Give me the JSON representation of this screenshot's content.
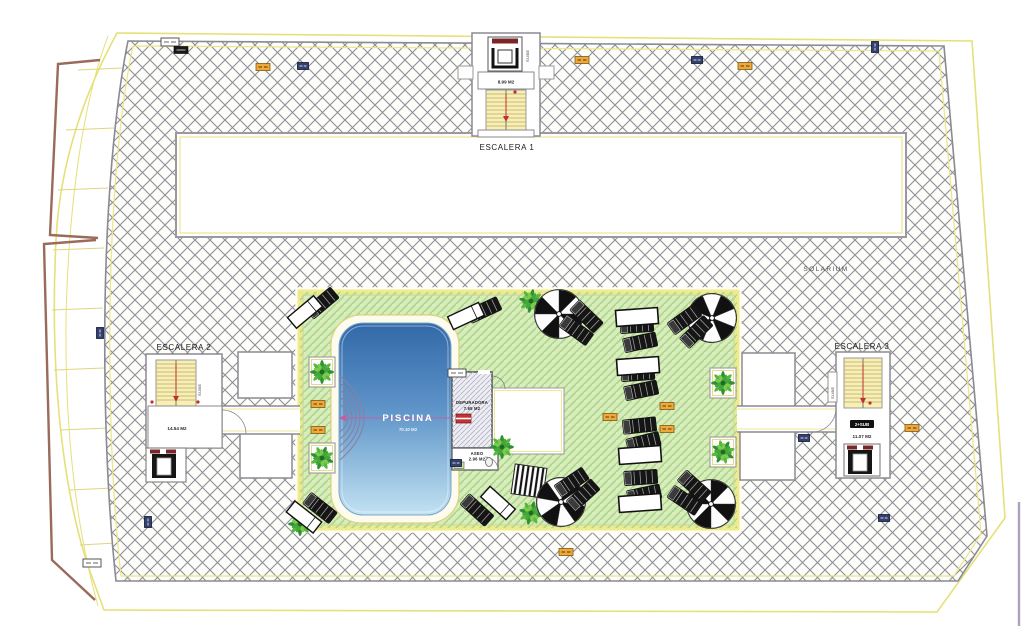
{
  "labels": {
    "escalera1": "ESCALERA 1",
    "escalera1_area": "8.99 M2",
    "escalera1_dir": "SUBE",
    "escalera2": "ESCALERA 2",
    "escalera2_area": "14.54 M2",
    "escalera2_dir": "SUBE",
    "escalera3": "ESCALERA 3",
    "escalera3_area": "11.07 M2",
    "escalera3_badge": "2+SUB",
    "escalera3_dir": "SUBE",
    "solarium": "SOLARIUM",
    "piscina": "PISCINA",
    "piscina_area": "70.10 M2",
    "depuradora": "DEPURADORA",
    "depuradora_area": "7.65 M2",
    "aseo": "ASEO",
    "aseo_area": "2.96 M2"
  },
  "colors": {
    "boundary_yellow": "#e6e07a",
    "hatch_gray": "#8a8a92",
    "lawn_green": "#d9ecbb",
    "lawn_hatch": "#aed890",
    "pool_top": "#3268a8",
    "pool_bottom": "#c2e2f2",
    "stair_yellow": "#f7efb4",
    "tag_orange": "#f0a83c",
    "tag_navy": "#34406e",
    "railing_brown": "#9a6a5a"
  },
  "plan_items": [
    {
      "type": "planter",
      "x": 322,
      "y": 372,
      "rot": 0
    },
    {
      "type": "planter",
      "x": 322,
      "y": 458,
      "rot": 0
    },
    {
      "type": "planter",
      "x": 723,
      "y": 383,
      "rot": 0
    },
    {
      "type": "planter",
      "x": 723,
      "y": 452,
      "rot": 0
    },
    {
      "type": "palm",
      "x": 322,
      "y": 372,
      "rot": 0
    },
    {
      "type": "palm",
      "x": 322,
      "y": 458,
      "rot": 20
    },
    {
      "type": "palm",
      "x": 723,
      "y": 383,
      "rot": 0
    },
    {
      "type": "palm",
      "x": 723,
      "y": 452,
      "rot": 30
    },
    {
      "type": "palm",
      "x": 531,
      "y": 301,
      "rot": 10
    },
    {
      "type": "palm",
      "x": 502,
      "y": 447,
      "rot": 0
    },
    {
      "type": "palm",
      "x": 531,
      "y": 513,
      "rot": 15
    },
    {
      "type": "palm",
      "x": 300,
      "y": 524,
      "rot": 0
    },
    {
      "type": "parasol",
      "x": 559,
      "y": 314,
      "rot": 0
    },
    {
      "type": "parasol",
      "x": 712,
      "y": 318,
      "rot": 22
    },
    {
      "type": "parasol",
      "x": 561,
      "y": 502,
      "rot": 10
    },
    {
      "type": "parasol",
      "x": 711,
      "y": 504,
      "rot": 0
    },
    {
      "type": "lounger-pair",
      "x": 638,
      "y": 334,
      "rot": -8
    },
    {
      "type": "lounger-pair",
      "x": 639,
      "y": 382,
      "rot": -8
    },
    {
      "type": "lounger-pair",
      "x": 641,
      "y": 434,
      "rot": -10
    },
    {
      "type": "lounger-pair",
      "x": 642,
      "y": 486,
      "rot": -8
    },
    {
      "type": "lounger-pair",
      "x": 581,
      "y": 323,
      "rot": 40
    },
    {
      "type": "lounger-pair",
      "x": 690,
      "y": 326,
      "rot": -40
    },
    {
      "type": "lounger-pair",
      "x": 577,
      "y": 489,
      "rot": -38
    },
    {
      "type": "lounger-pair",
      "x": 689,
      "y": 493,
      "rot": 38
    },
    {
      "type": "lounger-black",
      "x": 322,
      "y": 303,
      "rot": -40
    },
    {
      "type": "lounger-black",
      "x": 484,
      "y": 310,
      "rot": -25
    },
    {
      "type": "lounger-black",
      "x": 477,
      "y": 510,
      "rot": 42
    },
    {
      "type": "lounger-black",
      "x": 320,
      "y": 508,
      "rot": 38
    },
    {
      "type": "lounger-white",
      "x": 305,
      "y": 312,
      "rot": -40
    },
    {
      "type": "lounger-white",
      "x": 466,
      "y": 316,
      "rot": -25
    },
    {
      "type": "lounger-white",
      "x": 498,
      "y": 503,
      "rot": 42
    },
    {
      "type": "lounger-white",
      "x": 304,
      "y": 517,
      "rot": 38
    },
    {
      "type": "table-white",
      "x": 637,
      "y": 317,
      "rot": -4
    },
    {
      "type": "table-white",
      "x": 638,
      "y": 366,
      "rot": -4
    },
    {
      "type": "table-white",
      "x": 640,
      "y": 455,
      "rot": -4
    },
    {
      "type": "table-white",
      "x": 640,
      "y": 503,
      "rot": -4
    },
    {
      "type": "tag-orange",
      "x": 263,
      "y": 67,
      "rot": 0
    },
    {
      "type": "tag-orange",
      "x": 582,
      "y": 60,
      "rot": 0
    },
    {
      "type": "tag-orange",
      "x": 745,
      "y": 66,
      "rot": 0
    },
    {
      "type": "tag-orange",
      "x": 912,
      "y": 428,
      "rot": 0
    },
    {
      "type": "tag-orange",
      "x": 667,
      "y": 406,
      "rot": 0
    },
    {
      "type": "tag-orange",
      "x": 610,
      "y": 417,
      "rot": 0
    },
    {
      "type": "tag-orange",
      "x": 667,
      "y": 429,
      "rot": 0
    },
    {
      "type": "tag-orange",
      "x": 318,
      "y": 404,
      "rot": 0
    },
    {
      "type": "tag-orange",
      "x": 318,
      "y": 430,
      "rot": 0
    },
    {
      "type": "tag-orange",
      "x": 566,
      "y": 552,
      "rot": 0
    },
    {
      "type": "tag-navy",
      "x": 303,
      "y": 66,
      "rot": 0
    },
    {
      "type": "tag-navy",
      "x": 697,
      "y": 60,
      "rot": 0
    },
    {
      "type": "tag-navy",
      "x": 875,
      "y": 47,
      "rot": 90
    },
    {
      "type": "tag-navy",
      "x": 148,
      "y": 522,
      "rot": 90
    },
    {
      "type": "tag-navy",
      "x": 884,
      "y": 518,
      "rot": 0
    },
    {
      "type": "tag-navy",
      "x": 804,
      "y": 438,
      "rot": 0
    },
    {
      "type": "tag-navy",
      "x": 100,
      "y": 333,
      "rot": 90
    },
    {
      "type": "tag-navy",
      "x": 456,
      "y": 463,
      "rot": 0
    },
    {
      "type": "tag-white",
      "x": 170,
      "y": 42,
      "rot": 0
    },
    {
      "type": "tag-white",
      "x": 457,
      "y": 373,
      "rot": 0
    },
    {
      "type": "tag-white",
      "x": 92,
      "y": 563,
      "rot": 0
    },
    {
      "type": "tag-black",
      "x": 181,
      "y": 50,
      "rot": 0
    }
  ]
}
